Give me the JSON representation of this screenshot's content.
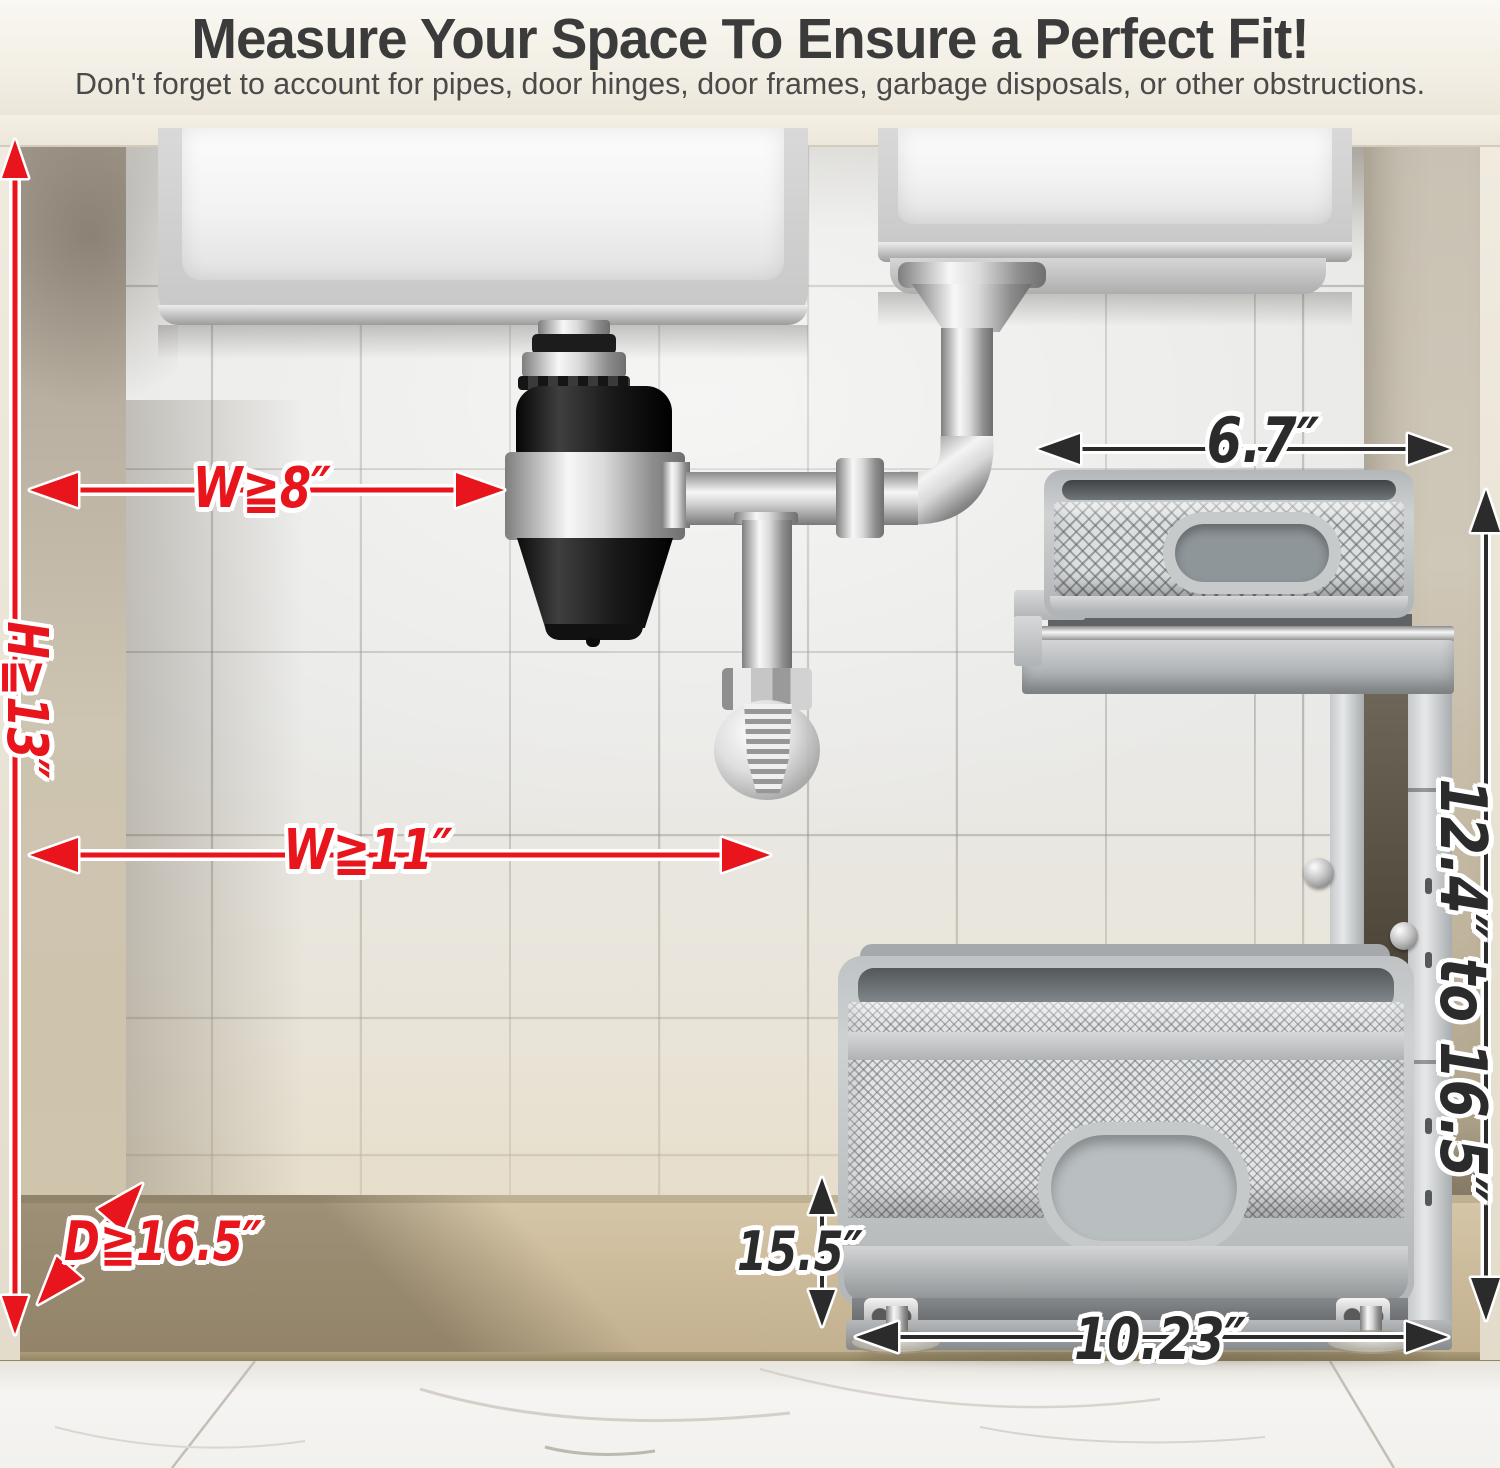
{
  "header": {
    "title": "Measure Your Space To Ensure a Perfect Fit!",
    "subtitle": "Don't forget to account for pipes, door hinges, door frames, garbage disposals, or other obstructions."
  },
  "annotations": {
    "red_color": "#e8151c",
    "dark_color": "#2b2b2b",
    "cabinet_width_top": "W≧8″",
    "cabinet_height": "H≧13″",
    "cabinet_width_mid": "W≧11″",
    "cabinet_depth": "D≧16.5″",
    "top_basket_width": "6.7″",
    "frame_height_range": "12.4″ to 16.5″",
    "organizer_height": "15.5″",
    "bottom_basket_width": "10.23″"
  }
}
